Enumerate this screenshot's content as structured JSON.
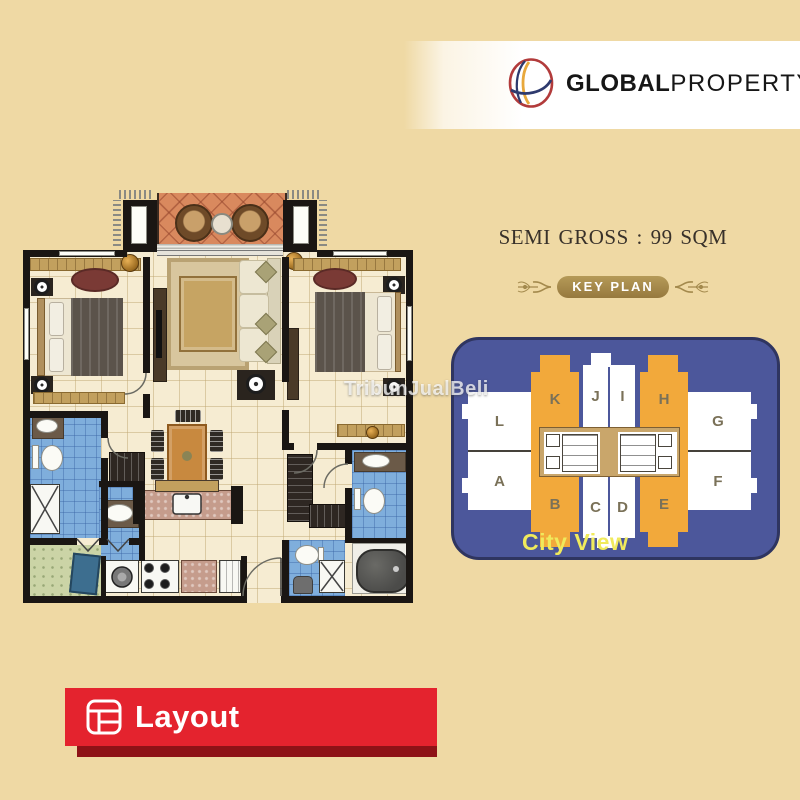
{
  "brand": {
    "bold": "GLOBAL",
    "light": "PROPERTY"
  },
  "listing": {
    "area_label": "SEMI GROSS : 99 SQM"
  },
  "key_plan": {
    "badge": "KEY PLAN",
    "city_view": "City View",
    "wings": {
      "left_top": "L",
      "left_bottom": "A",
      "right_top": "G",
      "right_bottom": "F"
    },
    "towers_top": [
      {
        "label": "K"
      },
      {
        "label": "J"
      },
      {
        "label": "I"
      },
      {
        "label": "H"
      }
    ],
    "towers_bottom": [
      {
        "label": "B"
      },
      {
        "label": "C"
      },
      {
        "label": "D"
      },
      {
        "label": "E"
      }
    ],
    "highlighted_units": [
      "K",
      "H",
      "B",
      "E"
    ],
    "colors": {
      "panel": "#4C579B",
      "highlight_unit": "#F2A93B",
      "regular_unit": "#FFFFFF",
      "unit_label": "#7A7158",
      "city_view_text": "#F0EA5C"
    }
  },
  "floor_plan": {
    "watermark": "TribunJualBeli"
  },
  "footer": {
    "tab_label": "Layout",
    "color": "#E4232E",
    "shadow_color": "#8E1217"
  },
  "page": {
    "background": "#EFD9A4"
  }
}
